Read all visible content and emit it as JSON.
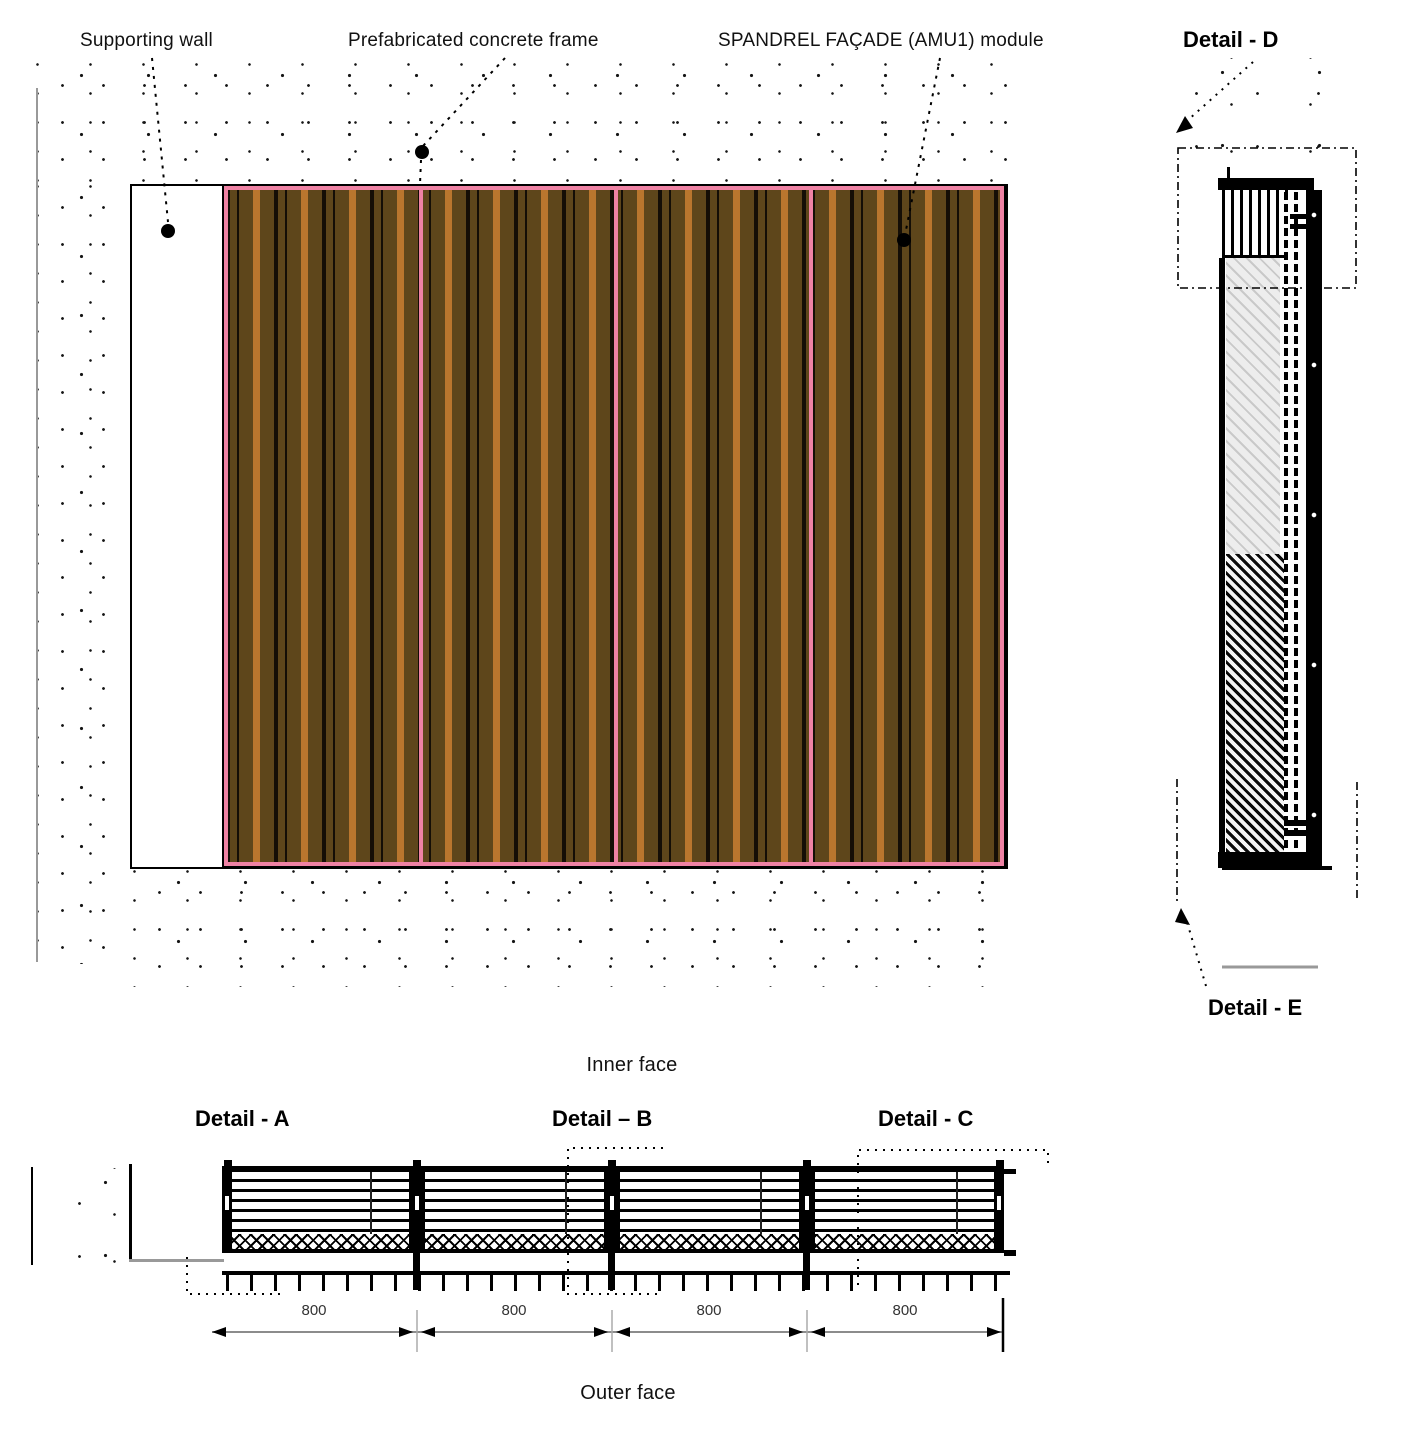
{
  "drawing": {
    "annotations": {
      "supporting_wall": "Supporting wall",
      "concrete_frame": "Prefabricated concrete frame",
      "spandrel_module": "SPANDREL FAÇADE (AMU1) module"
    },
    "details": {
      "a": "Detail - A",
      "b": "Detail – B",
      "c": "Detail - C",
      "d": "Detail - D",
      "e": "Detail - E"
    },
    "faces": {
      "inner": "Inner face",
      "outer": "Outer face"
    },
    "dimensions": {
      "segments": [
        "800",
        "800",
        "800",
        "800"
      ]
    },
    "colors": {
      "slat_dark": "#5e461b",
      "slat_light": "#b9762e",
      "module_frame_pink": "#ef82a4",
      "line_black": "#141414",
      "dim_gray": "#8c8c8c"
    }
  }
}
